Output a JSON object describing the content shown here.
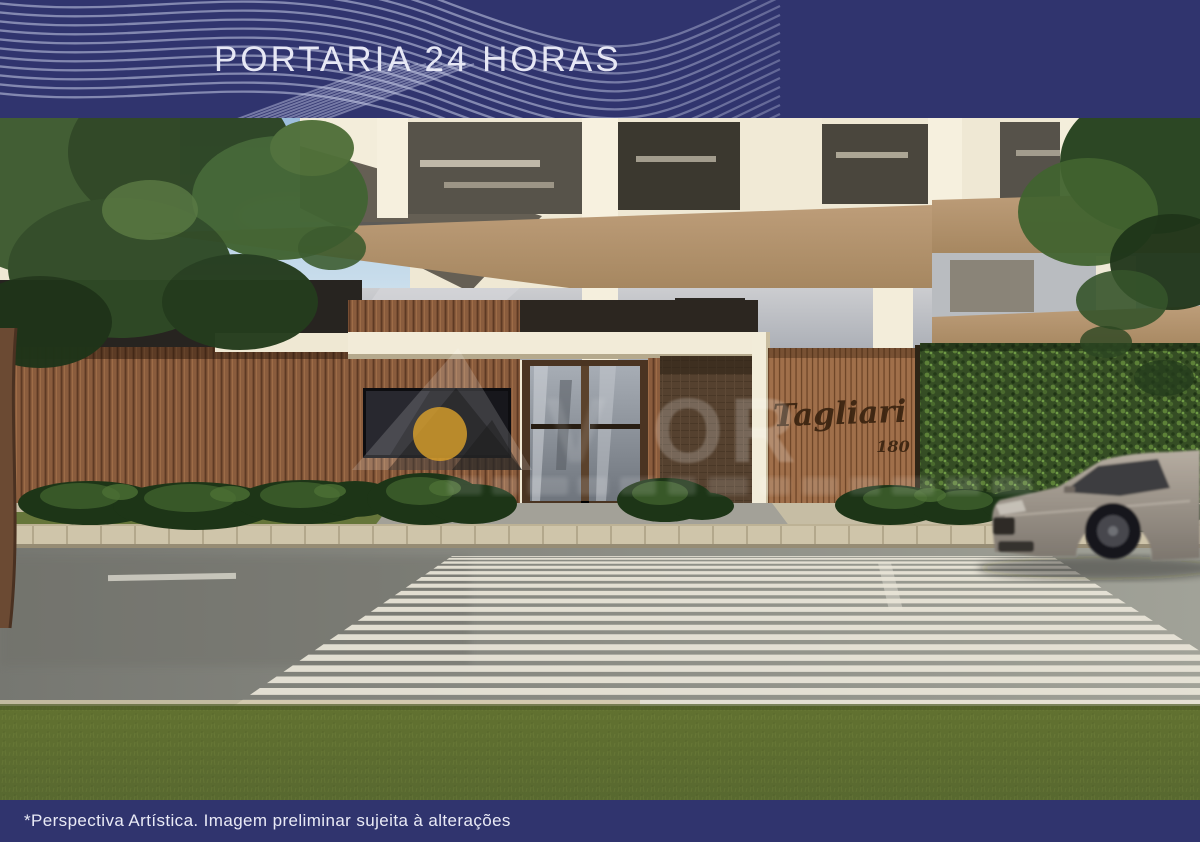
{
  "header": {
    "title": "PORTARIA 24 HORAS",
    "background_color": "#30346e",
    "wave_color": "#c9cde8"
  },
  "footer": {
    "disclaimer": "*Perspectiva Artística. Imagem preliminar sujeita à alterações",
    "background_color": "#30346e"
  },
  "scene": {
    "description": "Architectural rendering of residential building street entrance with 24-hour concierge lobby, wood slat walls, vertical garden, crosswalk and passing car",
    "building_sign": {
      "name": "Tagliari",
      "number": "180"
    },
    "palette": {
      "navy": "#30346e",
      "facade_cream": "#efe8d4",
      "slab_tan": "#b59573",
      "wood_slat": "#8a5c3d",
      "sign_wood": "#a06f4a",
      "hedge_green": "#354d24",
      "road_gray": "#8b8c84",
      "crosswalk_stripe": "#eae5d8",
      "grass_green": "#5c6c32",
      "car_body": "#a89f95"
    }
  },
  "watermark": {
    "visible_letters": "OR",
    "legible": false,
    "logo_accent_color": "#dda32a"
  }
}
